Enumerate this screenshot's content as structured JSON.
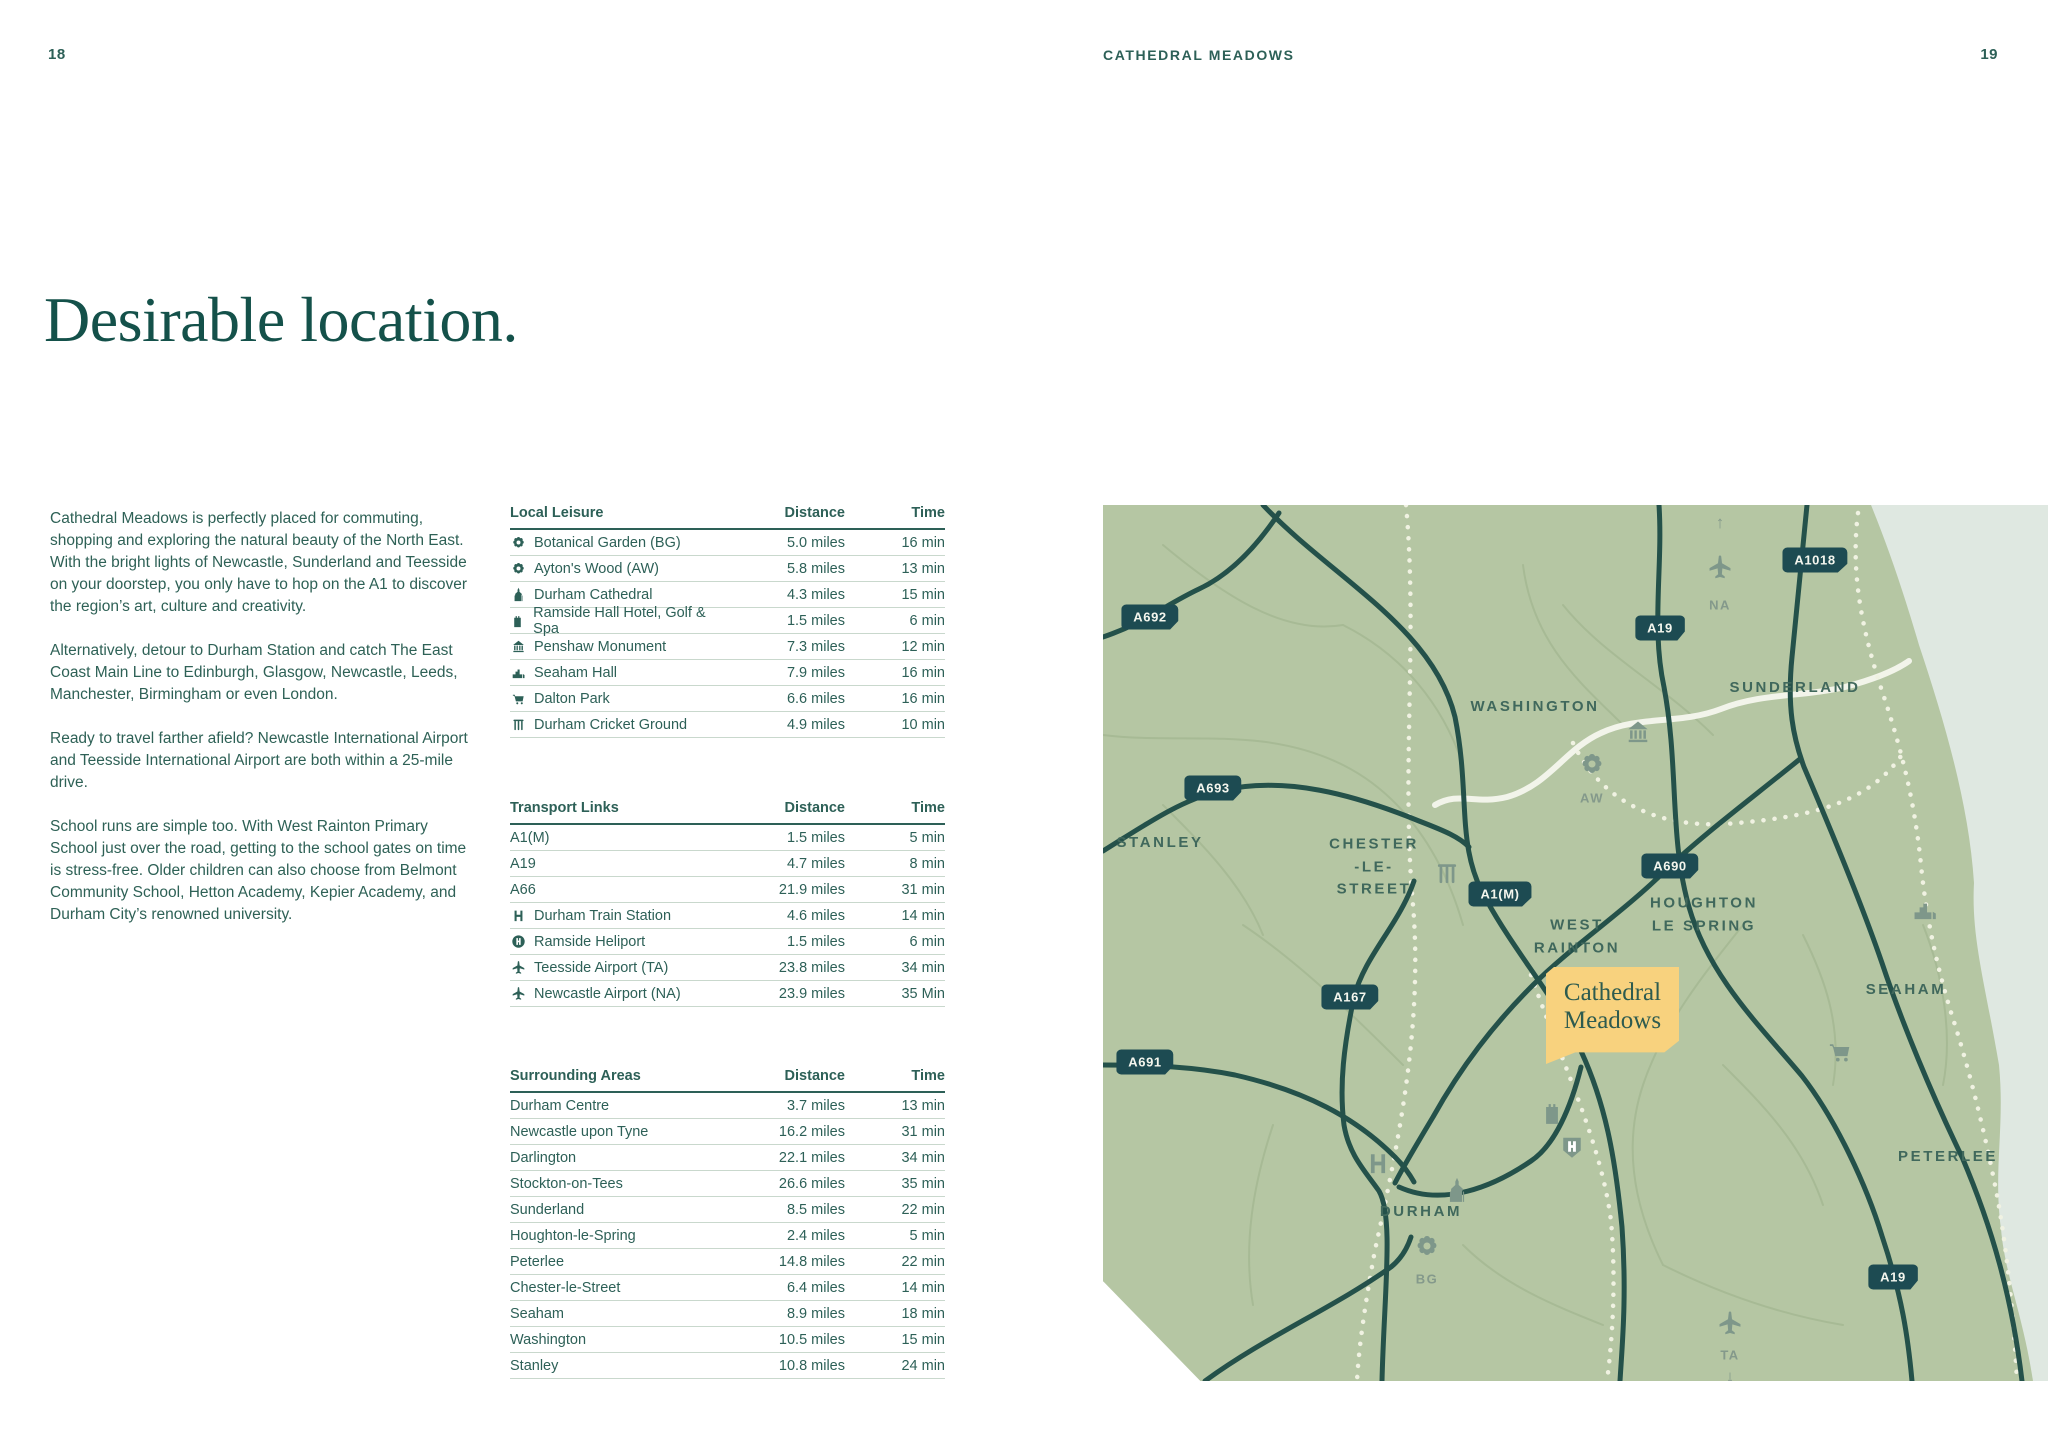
{
  "page": {
    "left_number": "18",
    "header": "CATHEDRAL MEADOWS",
    "right_number": "19",
    "title": "Desirable location."
  },
  "intro": {
    "paragraphs": [
      "Cathedral Meadows is perfectly placed for commuting, shopping and exploring the natural beauty of the North East. With the bright lights of Newcastle, Sunderland and Teesside on your doorstep, you only have to hop on the A1 to discover the region’s art, culture and creativity.",
      "Alternatively, detour to Durham Station and catch The East Coast Main Line to Edinburgh, Glasgow, Newcastle, Leeds, Manchester, Birmingham or even London.",
      "Ready to travel farther afield? Newcastle International Airport and Teesside International Airport are both within a 25-mile drive.",
      "School runs are simple too. With West Rainton Primary School just over the road, getting to the school gates on time is stress-free. Older children can also choose from Belmont Community School, Hetton Academy, Kepier Academy, and Durham City’s renowned university."
    ]
  },
  "tables": [
    {
      "title": "Local Leisure",
      "col_distance": "Distance",
      "col_time": "Time",
      "rows": [
        {
          "icon": "flower",
          "name": "Botanical Garden (BG)",
          "distance": "5.0 miles",
          "time": "16 min"
        },
        {
          "icon": "flower",
          "name": "Ayton's Wood (AW)",
          "distance": "5.8 miles",
          "time": "13 min"
        },
        {
          "icon": "cathedral",
          "name": "Durham Cathedral",
          "distance": "4.3 miles",
          "time": "15 min"
        },
        {
          "icon": "castle",
          "name": "Ramside Hall Hotel, Golf & Spa",
          "distance": "1.5 miles",
          "time": "6 min"
        },
        {
          "icon": "monument",
          "name": "Penshaw Monument",
          "distance": "7.3 miles",
          "time": "12 min"
        },
        {
          "icon": "building",
          "name": "Seaham Hall",
          "distance": "7.9 miles",
          "time": "16 min"
        },
        {
          "icon": "shopping",
          "name": "Dalton Park",
          "distance": "6.6 miles",
          "time": "16 min"
        },
        {
          "icon": "cricket",
          "name": "Durham Cricket Ground",
          "distance": "4.9 miles",
          "time": "10 min"
        }
      ]
    },
    {
      "title": "Transport Links",
      "col_distance": "Distance",
      "col_time": "Time",
      "rows": [
        {
          "icon": null,
          "name": "A1(M)",
          "distance": "1.5 miles",
          "time": "5 min"
        },
        {
          "icon": null,
          "name": "A19",
          "distance": "4.7 miles",
          "time": "8 min"
        },
        {
          "icon": null,
          "name": "A66",
          "distance": "21.9 miles",
          "time": "31 min"
        },
        {
          "icon": "train",
          "name": "Durham Train Station",
          "distance": "4.6 miles",
          "time": "14 min"
        },
        {
          "icon": "heliport",
          "name": "Ramside Heliport",
          "distance": "1.5 miles",
          "time": "6 min"
        },
        {
          "icon": "plane",
          "name": "Teesside Airport (TA)",
          "distance": "23.8 miles",
          "time": "34 min"
        },
        {
          "icon": "plane",
          "name": "Newcastle Airport (NA)",
          "distance": "23.9 miles",
          "time": "35 Min"
        }
      ]
    },
    {
      "title": "Surrounding Areas",
      "col_distance": "Distance",
      "col_time": "Time",
      "rows": [
        {
          "icon": null,
          "name": "Durham Centre",
          "distance": "3.7 miles",
          "time": "13 min"
        },
        {
          "icon": null,
          "name": "Newcastle upon Tyne",
          "distance": "16.2 miles",
          "time": "31 min"
        },
        {
          "icon": null,
          "name": "Darlington",
          "distance": "22.1 miles",
          "time": "34 min"
        },
        {
          "icon": null,
          "name": "Stockton-on-Tees",
          "distance": "26.6 miles",
          "time": "35 min"
        },
        {
          "icon": null,
          "name": "Sunderland",
          "distance": "8.5 miles",
          "time": "22 min"
        },
        {
          "icon": null,
          "name": "Houghton-le-Spring",
          "distance": "2.4 miles",
          "time": "5 min"
        },
        {
          "icon": null,
          "name": "Peterlee",
          "distance": "14.8 miles",
          "time": "22 min"
        },
        {
          "icon": null,
          "name": "Chester-le-Street",
          "distance": "6.4 miles",
          "time": "14 min"
        },
        {
          "icon": null,
          "name": "Seaham",
          "distance": "8.9 miles",
          "time": "18 min"
        },
        {
          "icon": null,
          "name": "Washington",
          "distance": "10.5 miles",
          "time": "15 min"
        },
        {
          "icon": null,
          "name": "Stanley",
          "distance": "10.8 miles",
          "time": "24 min"
        }
      ]
    }
  ],
  "map": {
    "badges": [
      {
        "label": "A692"
      },
      {
        "label": "A693"
      },
      {
        "label": "A1018"
      },
      {
        "label": "A19"
      },
      {
        "label": "A690"
      },
      {
        "label": "A1(M)"
      },
      {
        "label": "A167"
      },
      {
        "label": "A691"
      },
      {
        "label": "A19"
      }
    ],
    "labels": [
      {
        "text": "STANLEY"
      },
      {
        "text": "WASHINGTON"
      },
      {
        "text": "CHESTER\n-LE-\nSTREET"
      },
      {
        "text": "SUNDERLAND"
      },
      {
        "text": "WEST\nRAINTON"
      },
      {
        "text": "HOUGHTON\nLE SPRING"
      },
      {
        "text": "SEAHAM"
      },
      {
        "text": "PETERLEE"
      },
      {
        "text": "DURHAM"
      }
    ],
    "marker": {
      "text": "Cathedral\nMeadows"
    },
    "poi_labels": {
      "na": "NA",
      "aw": "AW",
      "bg": "BG",
      "ta": "TA"
    },
    "arrows": {
      "up": "↑",
      "down": "↓"
    }
  },
  "colors": {
    "text_teal": "#2d6057",
    "title_teal": "#14514a",
    "map_land": "#b5c6a3",
    "map_sea": "#dfe8e1",
    "map_road": "#24514a",
    "badge_bg": "#1d4b52",
    "marker_yellow": "#f8d27e",
    "rule_light": "#c9d8cd"
  }
}
